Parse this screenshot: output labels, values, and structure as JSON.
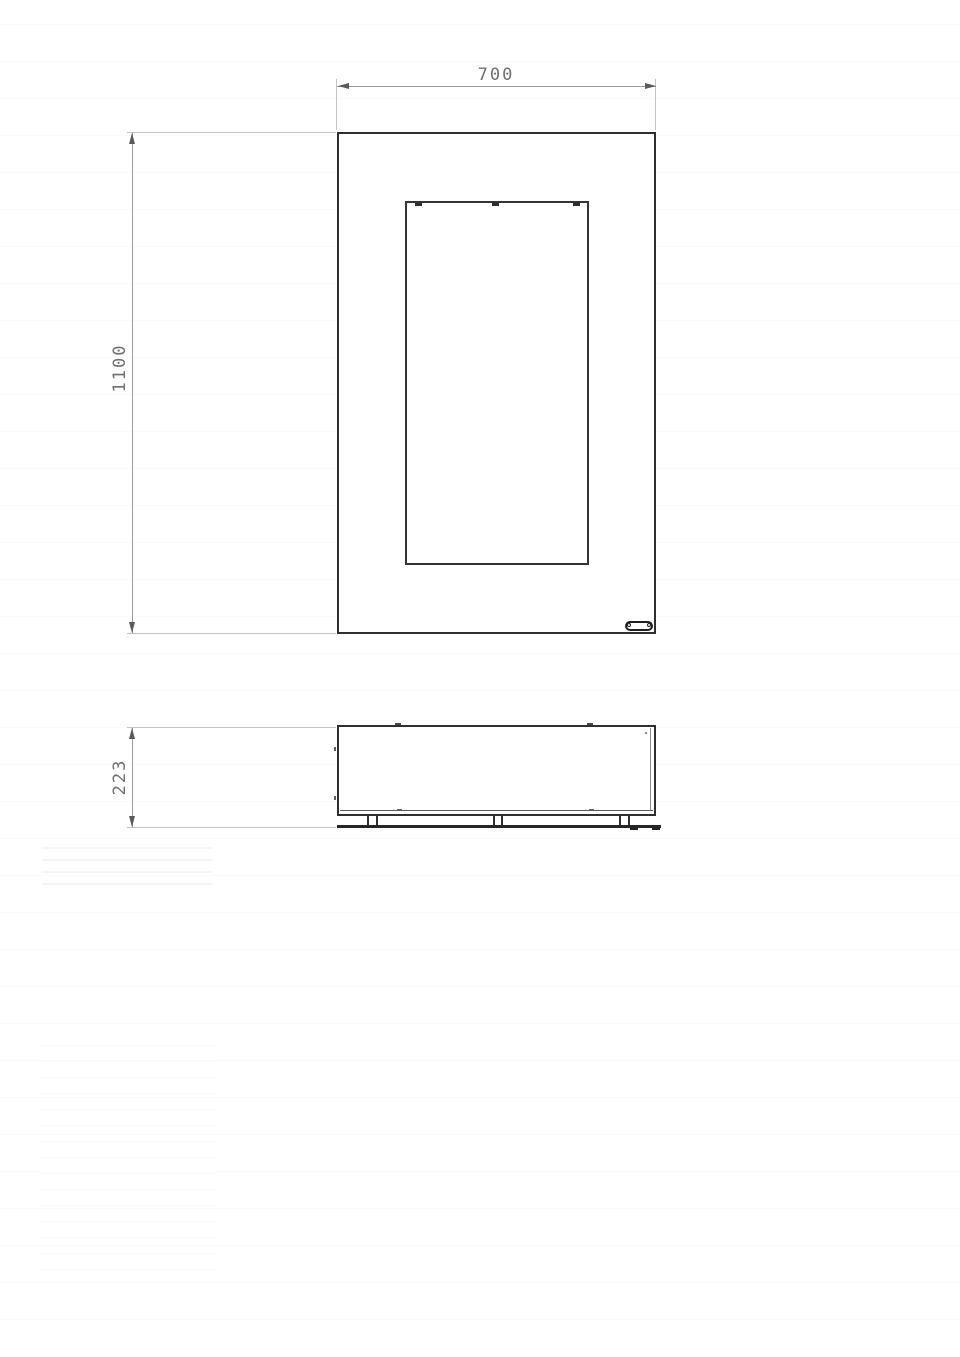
{
  "drawing": {
    "dimensions": {
      "width_label": "700",
      "height_label": "1100",
      "depth_label": "223"
    },
    "icons": {
      "dimension_arrow": "filled-triangle",
      "badge": "pill-nameplate-with-two-screws"
    },
    "colors": {
      "background": "#ffffff",
      "object_line": "#2e2e2e",
      "dimension_line": "#9a9a9a",
      "extension_line": "#c3c3c3",
      "arrow": "#5a5a5a",
      "dimension_text": "#6f6f6f"
    }
  }
}
